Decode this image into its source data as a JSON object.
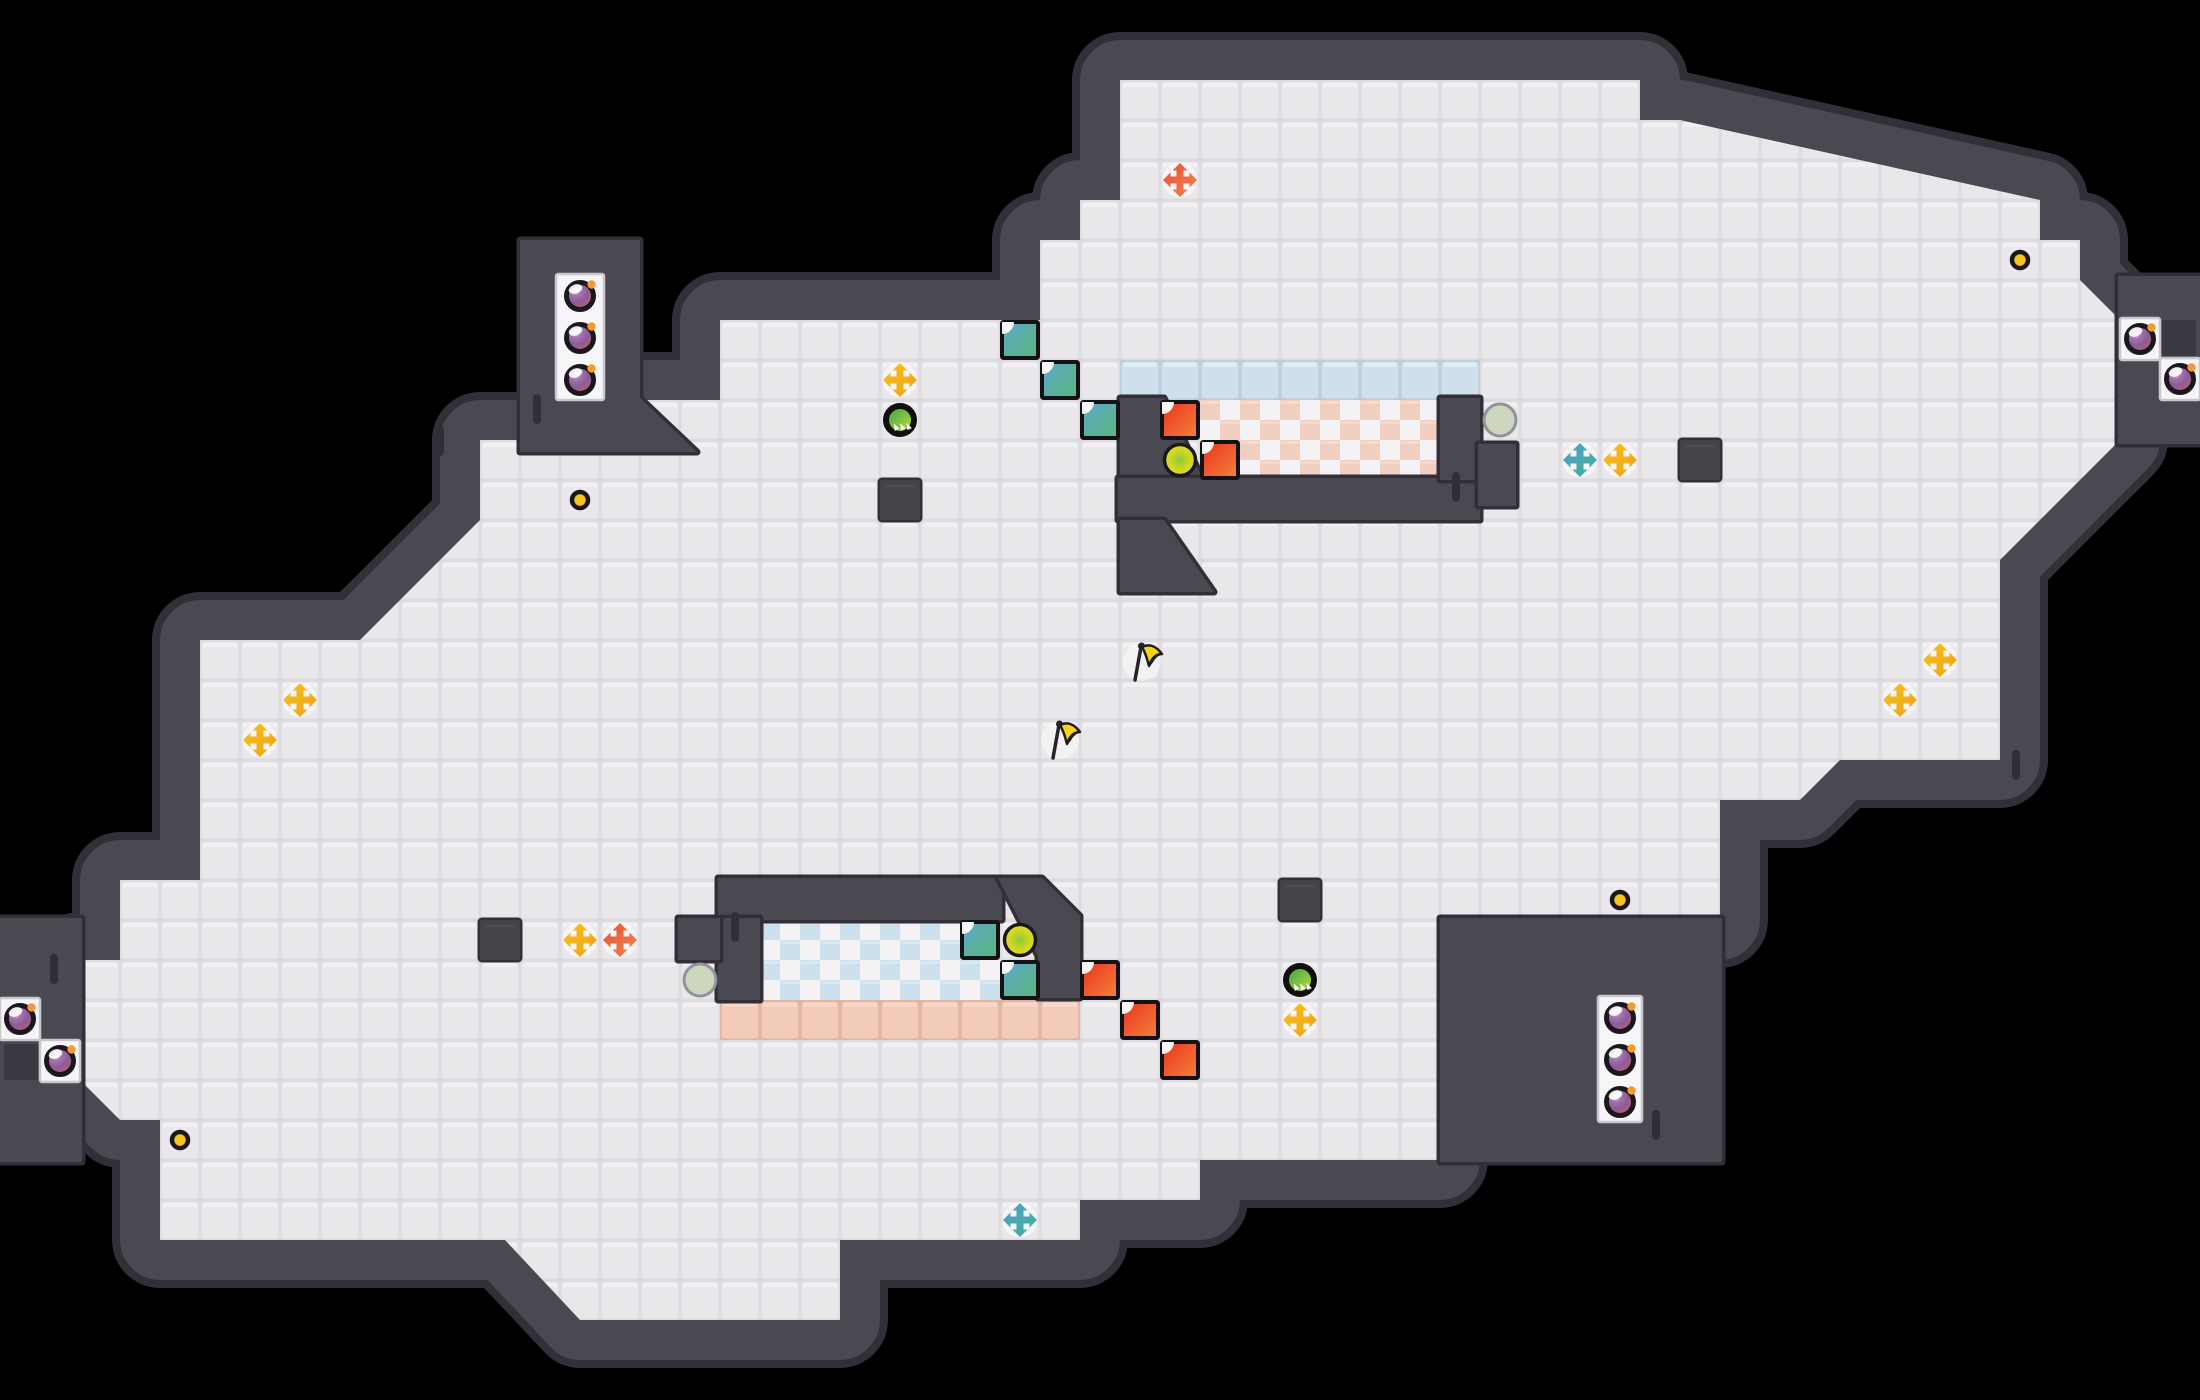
{
  "meta": {
    "description": "Top-down tile-based puzzle game level map on black background",
    "counts": {
      "bombs": 10,
      "arrow_crosses": 12,
      "flags": 2,
      "notch_squares": 10,
      "ring_orbs": 2,
      "spike_orbs": 2,
      "rocks": 2,
      "coins": 4,
      "wall_blocks": 4
    }
  },
  "scene": {
    "width": 2200,
    "height": 1400,
    "tile": 40,
    "bg": "#000000"
  },
  "palette": {
    "wall": "#4a4850",
    "wall_outline": "#322f38",
    "wall_block": "#454249",
    "wall_tick": "#302e36",
    "wall_recess": "#3a3840",
    "floor_groove": "#dddbe0",
    "floor_body": "#e9e7ea",
    "floor_highlight": "#f3f1f4",
    "ice_groove": "#b9cfdf",
    "ice_body": "#cfdfec",
    "ice_highlight": "#e4eff7",
    "warm_groove": "#e0b49e",
    "warm_body": "#f2cab8",
    "warm_highlight": "#f8dbca",
    "checker_warm_cell": "#f0cfc0",
    "checker_cool_cell": "#cde0ee",
    "checker_white": "#f4f2f4",
    "niche_fill": "#f7f5f8",
    "niche_frame": "#c9c7ce",
    "bomb_ring": "#1a181c",
    "bomb_hi": "#ece2ea",
    "bomb_mid": "#a878b0",
    "bomb_deep": "#8c5a9a",
    "bomb_low": "#c4685a",
    "bomb_fuse": "#f49a30",
    "cross_yellow_a": "#f7c51a",
    "cross_yellow_b": "#ef9f16",
    "cross_orange_a": "#ea4f38",
    "cross_orange_b": "#f08448",
    "cross_teal_a": "#4e9fcf",
    "cross_teal_b": "#43b294",
    "square_teal_a": "#5fa8cc",
    "square_teal_b": "#57b87c",
    "square_red_a": "#e63222",
    "square_red_b": "#f5823a",
    "square_border": "#141214",
    "ring_orb_core": "#8cc83c",
    "ring_orb_mid": "#ccd822",
    "ring_orb_edge": "#eedc1c",
    "spike_orb_a": "#35a04a",
    "spike_orb_b": "#c6de3a",
    "rock_fill": "#ccd7be",
    "rock_stroke": "#90949a",
    "coin_fill": "#f5c220",
    "flag_cloth": "#f5d414",
    "flag_tip": "#f2a61c",
    "flag_pole": "#26242a"
  },
  "map": {
    "floor_outline": "M1120,80 L1640,80 L1640,120 L1680,120 L2040,200 L2040,240 L2080,240 L2080,280 L2120,320 L2120,440 L2000,560 L2000,760 L1840,760 L1800,800 L1720,800 L1720,920 L1440,920 L1440,1160 L1200,1160 L1200,1200 L1080,1200 L1080,1240 L840,1240 L840,1320 L580,1320 L505,1240 L160,1240 L160,1120 L120,1120 L80,1080 L80,960 L120,960 L120,880 L200,880 L200,640 L360,640 L480,520 L480,440 L640,440 L640,400 L720,400 L720,320 L1040,320 L1040,240 L1080,240 L1080,200 L1120,200 Z",
    "inner_walls": [
      {
        "name": "alcove-block-topleft",
        "d": "M520,240 L640,240 L640,398 L697,452 L520,452 Z"
      },
      {
        "name": "pool-top-left-wall",
        "d": "M1120,398 L1164,398 L1202,478 L1202,520 L1120,520 Z"
      },
      {
        "name": "pool-top-bottom-wall",
        "d": "M1118,478 L1480,478 L1480,520 L1118,520 Z"
      },
      {
        "name": "pool-top-right-wall",
        "d": "M1440,398 L1480,398 L1480,480 L1440,480 Z"
      },
      {
        "name": "pool-top-arm",
        "d": "M1478,444 L1516,444 L1516,506 L1478,506 Z"
      },
      {
        "name": "pool-top-wedge",
        "d": "M1120,520 L1164,520 L1214,592 L1120,592 Z"
      },
      {
        "name": "pool-bottom-top-wall",
        "d": "M718,878 L1002,878 L1002,920 L718,920 Z"
      },
      {
        "name": "pool-bottom-diag-wall",
        "d": "M998,878 L1042,878 L1080,916 L1080,998 L1038,998 L1038,956 Z"
      },
      {
        "name": "pool-bottom-left-wall",
        "d": "M718,918 L760,918 L760,1000 L718,1000 Z"
      },
      {
        "name": "pool-bottom-protrusion",
        "d": "M678,918 L720,918 L720,960 L678,960 Z"
      },
      {
        "name": "structure-bottom-right",
        "d": "M1440,918 L1722,918 L1722,1162 L1440,1162 Z"
      },
      {
        "name": "niche-wall-right-edge",
        "d": "M2118,276 L2200,276 L2200,444 L2118,444 Z"
      },
      {
        "name": "niche-wall-left-edge",
        "d": "M0,918 L82,918 L82,1162 L0,1162 Z"
      }
    ],
    "blocks": [
      [
        880,
        480
      ],
      [
        1680,
        440
      ],
      [
        1280,
        880
      ],
      [
        480,
        920
      ]
    ],
    "wall_ticks": [
      [
        436,
        426
      ],
      [
        533,
        394
      ],
      [
        731,
        912
      ],
      [
        1452,
        472
      ],
      [
        1652,
        1110
      ],
      [
        50,
        954
      ],
      [
        2012,
        750
      ]
    ],
    "wall_recesses": [
      [
        4,
        1044,
        34,
        36
      ],
      [
        2162,
        320,
        34,
        36
      ]
    ],
    "niches": [
      {
        "x": 556,
        "y": 274,
        "w": 48,
        "h": 126
      },
      {
        "x": 2120,
        "y": 318,
        "w": 40,
        "h": 42
      },
      {
        "x": 2160,
        "y": 358,
        "w": 40,
        "h": 42
      },
      {
        "x": 1598,
        "y": 996,
        "w": 44,
        "h": 126
      },
      {
        "x": 0,
        "y": 998,
        "w": 40,
        "h": 42
      },
      {
        "x": 40,
        "y": 1040,
        "w": 40,
        "h": 42
      }
    ],
    "zones": [
      {
        "kind": "ice",
        "x": 1120,
        "y": 360,
        "w": 360,
        "h": 40
      },
      {
        "kind": "checker_warm",
        "x": 1200,
        "y": 400,
        "w": 240,
        "h": 80
      },
      {
        "kind": "checker_cool",
        "x": 760,
        "y": 920,
        "w": 240,
        "h": 80
      },
      {
        "kind": "warm",
        "x": 720,
        "y": 1000,
        "w": 360,
        "h": 40
      }
    ]
  },
  "objects": {
    "bombs": [
      [
        580,
        296
      ],
      [
        580,
        338
      ],
      [
        580,
        380
      ],
      [
        2140,
        339
      ],
      [
        2180,
        379
      ],
      [
        1620,
        1018
      ],
      [
        1620,
        1060
      ],
      [
        1620,
        1102
      ],
      [
        20,
        1019
      ],
      [
        60,
        1061
      ]
    ],
    "crosses": [
      {
        "x": 900,
        "y": 380,
        "color": "yellow"
      },
      {
        "x": 1620,
        "y": 460,
        "color": "yellow"
      },
      {
        "x": 300,
        "y": 700,
        "color": "yellow"
      },
      {
        "x": 260,
        "y": 740,
        "color": "yellow"
      },
      {
        "x": 1940,
        "y": 660,
        "color": "yellow"
      },
      {
        "x": 1900,
        "y": 700,
        "color": "yellow"
      },
      {
        "x": 1300,
        "y": 1020,
        "color": "yellow"
      },
      {
        "x": 580,
        "y": 940,
        "color": "yellow"
      },
      {
        "x": 1180,
        "y": 180,
        "color": "orange"
      },
      {
        "x": 620,
        "y": 940,
        "color": "orange"
      },
      {
        "x": 1580,
        "y": 460,
        "color": "teal"
      },
      {
        "x": 1020,
        "y": 1220,
        "color": "teal"
      }
    ],
    "flags": [
      [
        1140,
        662
      ],
      [
        1058,
        740
      ]
    ],
    "notch_squares": [
      {
        "x": 1020,
        "y": 340,
        "color": "teal"
      },
      {
        "x": 1060,
        "y": 380,
        "color": "teal"
      },
      {
        "x": 1100,
        "y": 420,
        "color": "teal"
      },
      {
        "x": 980,
        "y": 940,
        "color": "teal"
      },
      {
        "x": 1020,
        "y": 980,
        "color": "teal"
      },
      {
        "x": 1180,
        "y": 420,
        "color": "red"
      },
      {
        "x": 1220,
        "y": 460,
        "color": "red"
      },
      {
        "x": 1100,
        "y": 980,
        "color": "red"
      },
      {
        "x": 1140,
        "y": 1020,
        "color": "red"
      },
      {
        "x": 1180,
        "y": 1060,
        "color": "red"
      }
    ],
    "ring_orbs": [
      [
        1180,
        460
      ],
      [
        1020,
        940
      ]
    ],
    "spike_orbs": [
      [
        900,
        420
      ],
      [
        1300,
        980
      ]
    ],
    "rocks": [
      [
        1500,
        420
      ],
      [
        700,
        980
      ]
    ],
    "coins": [
      [
        2020,
        260
      ],
      [
        580,
        500
      ],
      [
        1620,
        900
      ],
      [
        180,
        1140
      ]
    ]
  }
}
